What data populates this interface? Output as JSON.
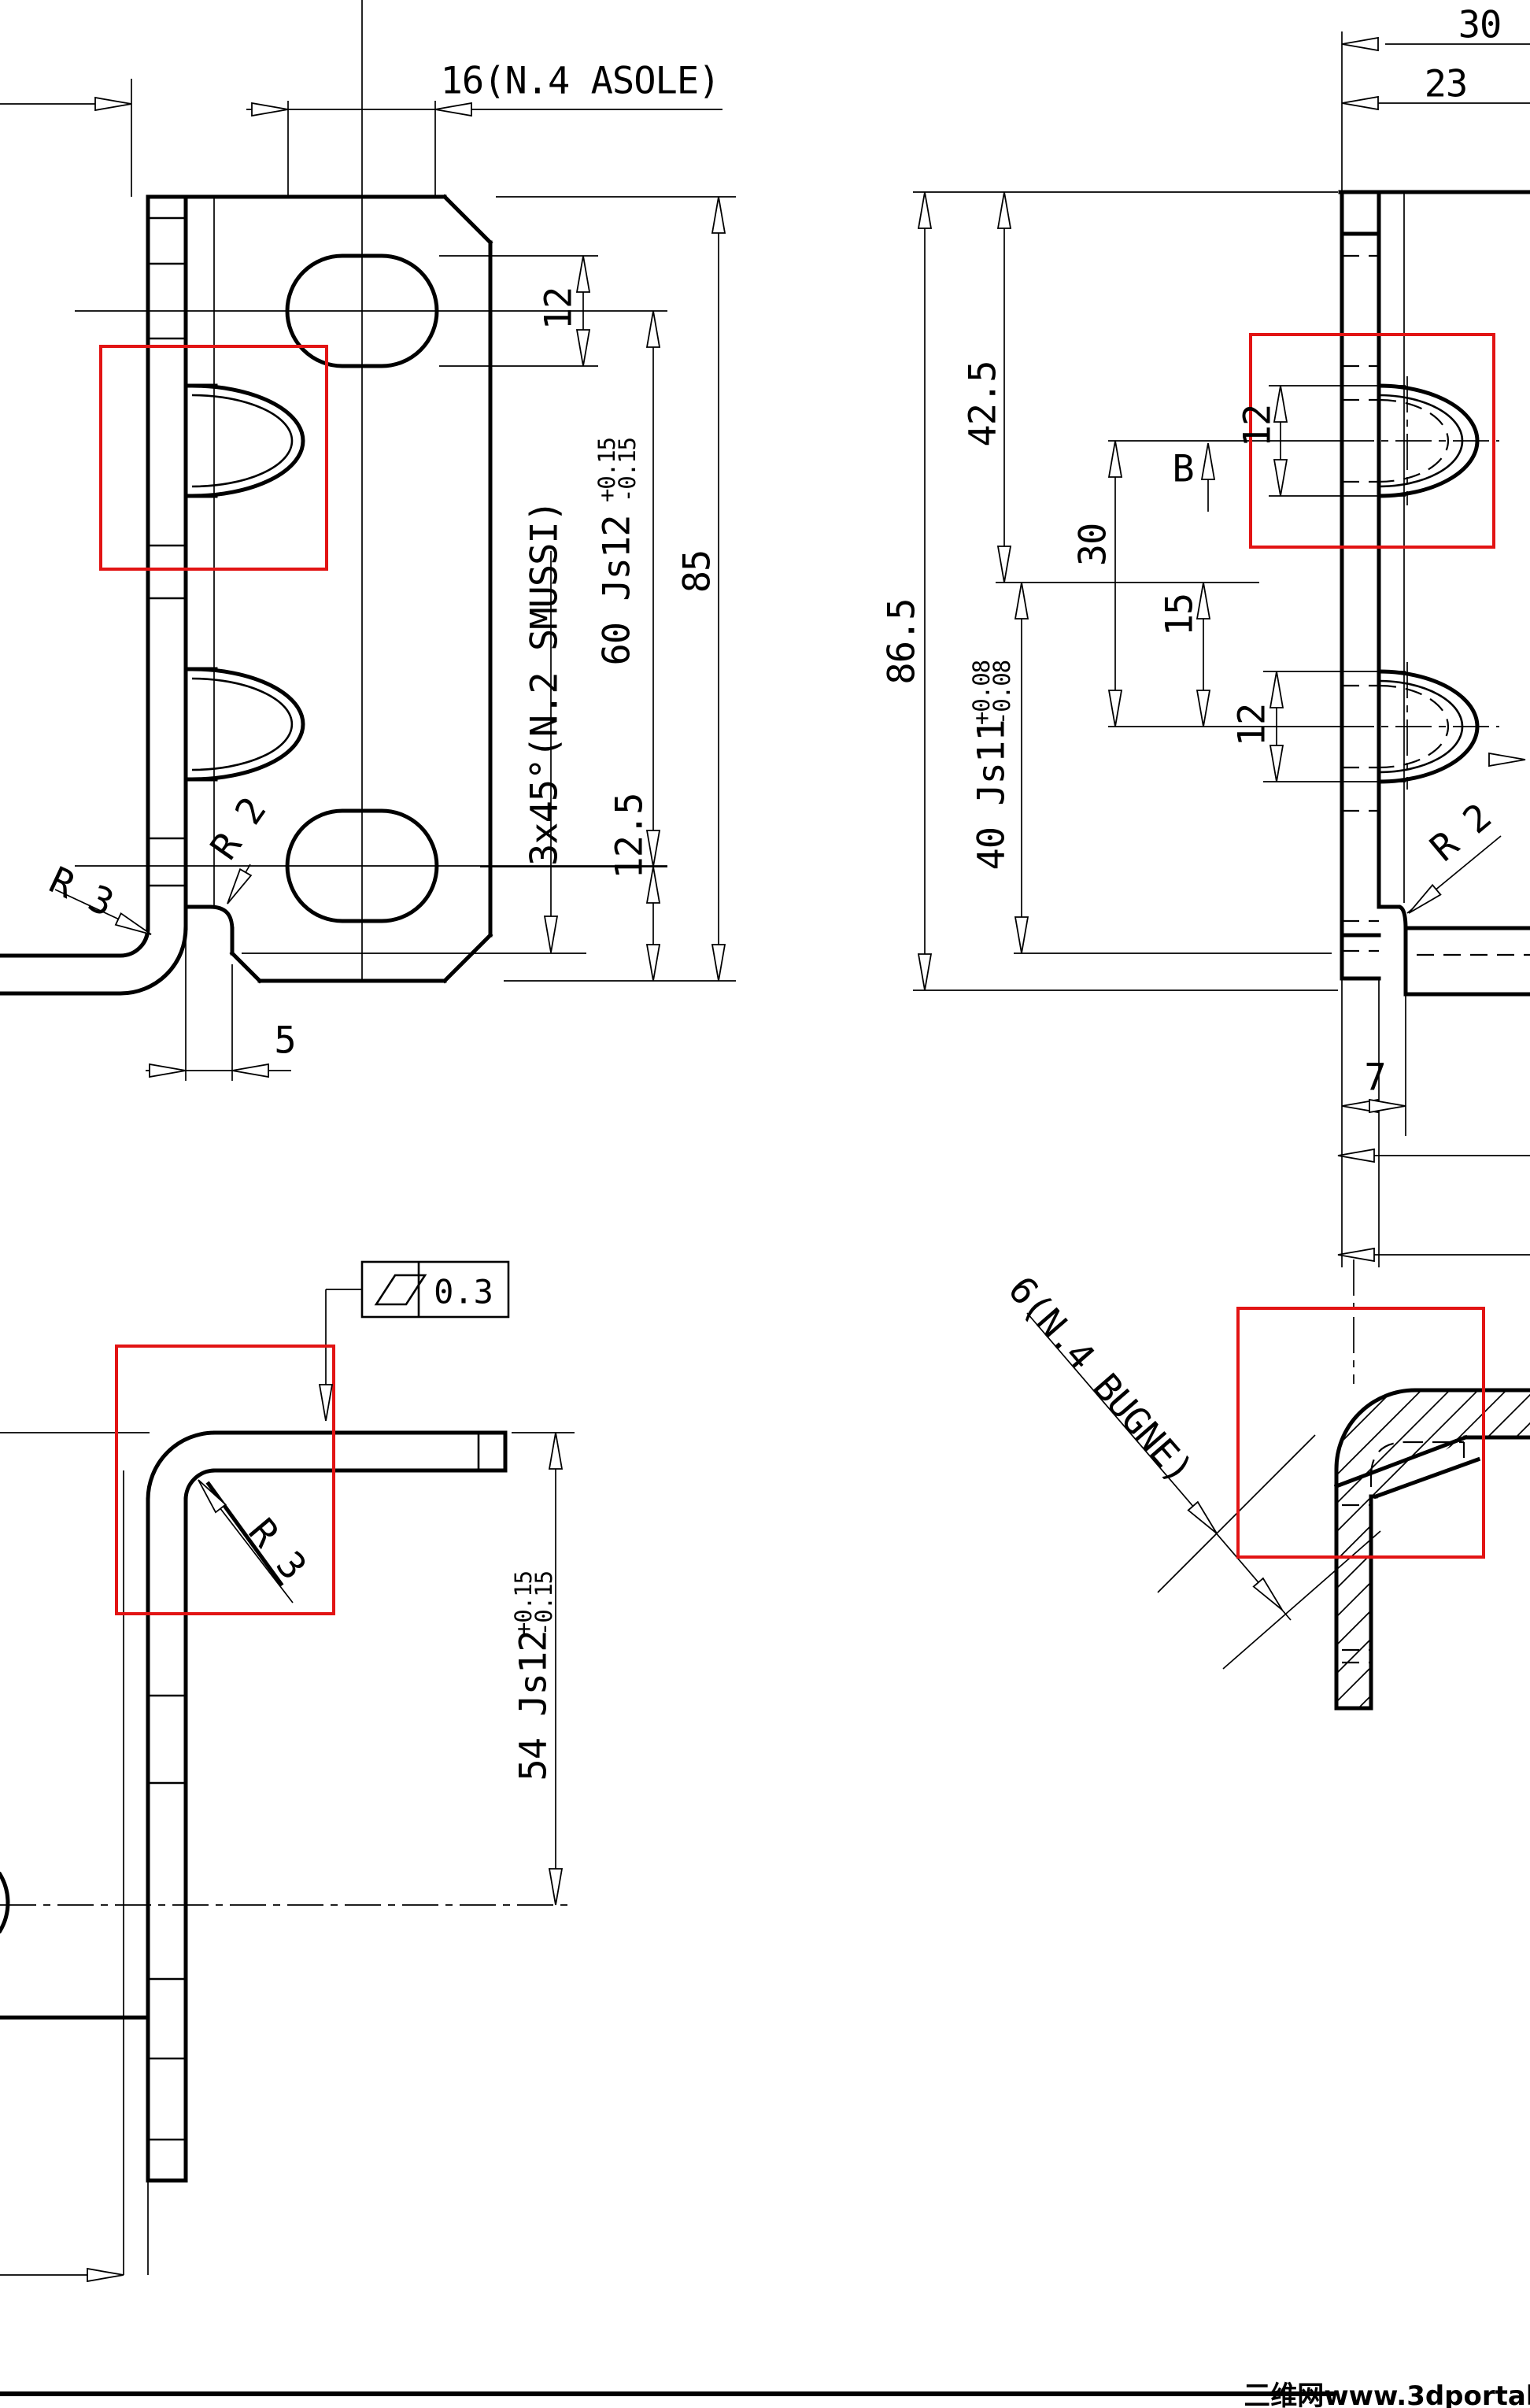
{
  "front": {
    "asole": "16(N.4 ASOLE)",
    "slot_width": "12",
    "plate_height": "85",
    "slot_spacing": "60 Js12",
    "slot_spacing_tol_plus": "+0.15",
    "slot_spacing_tol_minus": "-0.15",
    "chamfer": "3x45°(N.2 SMUSSI)",
    "bottom_offset": "12.5",
    "flange_width": "5",
    "radius_outer": "R 3",
    "radius_relief": "R 2"
  },
  "side": {
    "top_len": "30",
    "top_len2": "23",
    "total_height": "86.5",
    "center_offset": "42.5",
    "boss_span": "40 Js11",
    "boss_span_tol_plus": "+0.08",
    "boss_span_tol_minus": "-0.08",
    "boss_spacing": "30",
    "boss_half": "15",
    "boss_dia_top": "12",
    "boss_dia_bottom": "12",
    "detail_ref": "B",
    "radius_relief": "R 2",
    "flange_width": "7"
  },
  "profile": {
    "leg_height": "54 Js12",
    "leg_tol_plus": "+0.15",
    "leg_tol_minus": "-0.15",
    "radius": "R 3",
    "flatness_value": "0.3",
    "flatness_symbol": "parallelogram-flatness-icon"
  },
  "detail": {
    "boss_note": "6(N.4 BUGNE)"
  },
  "watermark": {
    "text": "三维网www.3dportal.cn"
  },
  "colors": {
    "highlight": "#e21414",
    "ink": "#000000",
    "watermark": "#e2382c"
  }
}
